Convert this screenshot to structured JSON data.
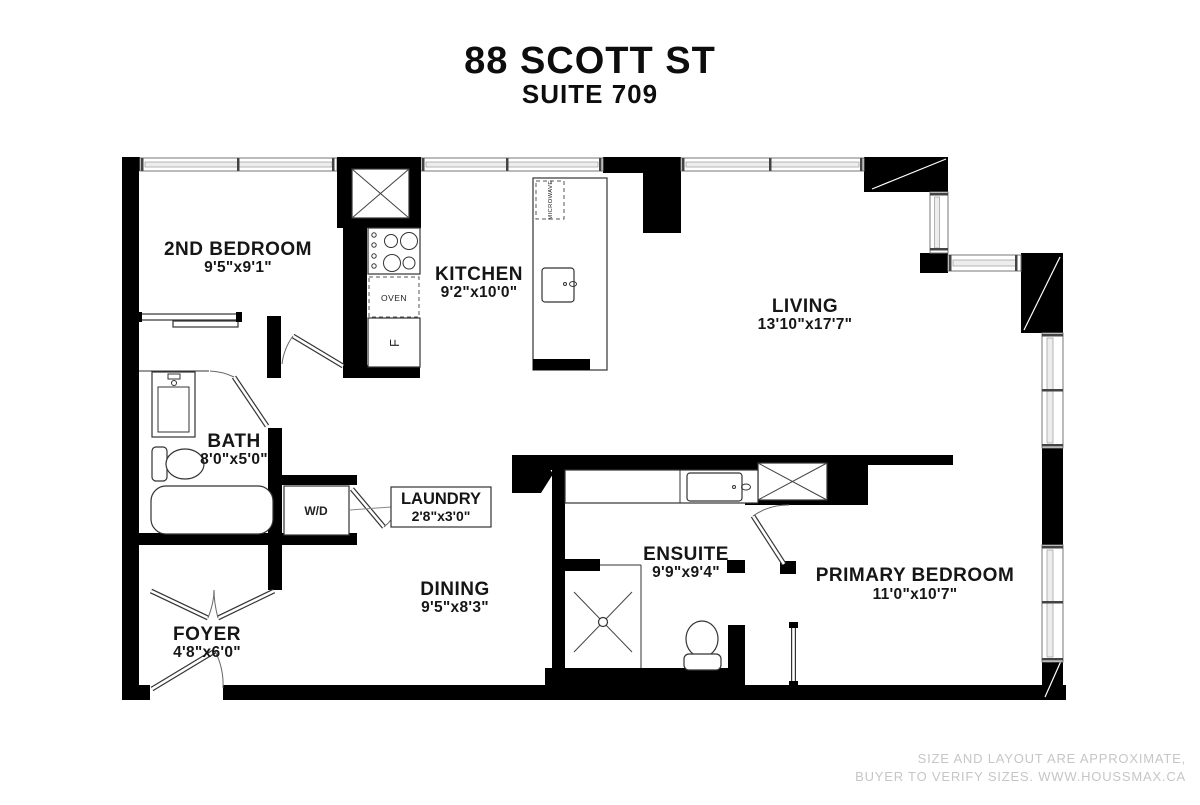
{
  "header": {
    "address": "88 SCOTT ST",
    "suite": "SUITE 709"
  },
  "rooms": {
    "second_bedroom": {
      "name": "2ND BEDROOM",
      "dims": "9'5\"x9'1\""
    },
    "kitchen": {
      "name": "KITCHEN",
      "dims": "9'2\"x10'0\""
    },
    "living": {
      "name": "LIVING",
      "dims": "13'10\"x17'7\""
    },
    "bath": {
      "name": "BATH",
      "dims": "8'0\"x5'0\""
    },
    "laundry": {
      "name": "LAUNDRY",
      "dims": "2'8\"x3'0\""
    },
    "dining": {
      "name": "DINING",
      "dims": "9'5\"x8'3\""
    },
    "foyer": {
      "name": "FOYER",
      "dims": "4'8\"x6'0\""
    },
    "ensuite": {
      "name": "ENSUITE",
      "dims": "9'9\"x9'4\""
    },
    "primary_bedroom": {
      "name": "PRIMARY BEDROOM",
      "dims": "11'0\"x10'7\""
    }
  },
  "fixtures": {
    "oven": "OVEN",
    "washer_dryer": "W/D",
    "microwave": "MICROWAVE",
    "fridge": "F"
  },
  "footer": {
    "line1": "SIZE AND LAYOUT ARE APPROXIMATE,",
    "line2": "BUYER TO VERIFY SIZES. WWW.HOUSSMAX.CA"
  },
  "colors": {
    "wall": "#000000",
    "watermark": "#c6c6c6",
    "background": "#ffffff"
  }
}
